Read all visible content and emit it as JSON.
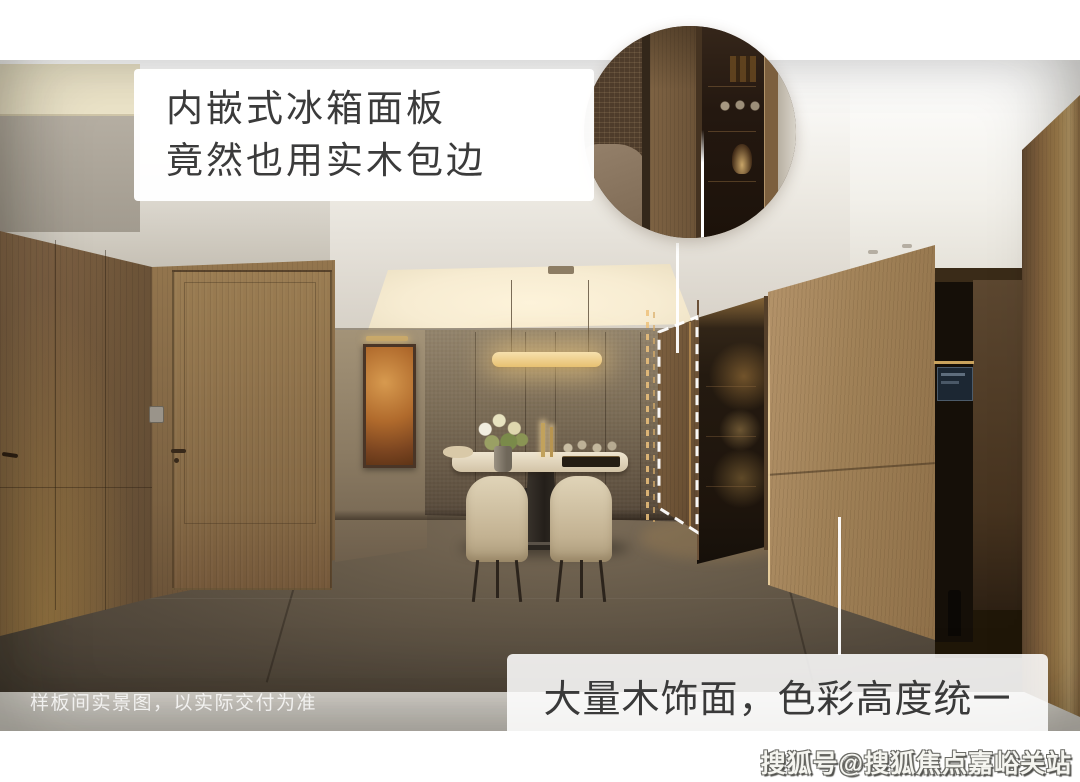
{
  "annotations": {
    "fridge_note_line1": "内嵌式冰箱面板",
    "fridge_note_line2": "竟然也用实木包边",
    "wood_note": "大量木饰面，色彩高度统一",
    "disclaimer": "样板间实景图，以实际交付为准",
    "watermark": "搜狐号@搜狐焦点嘉峪关站"
  },
  "colors": {
    "annotation_text": "#3b3b3b",
    "callout_background": "#ffffff",
    "connector_line": "#ffffff",
    "dashed_outline": "#ffffff",
    "wood_light": "#a5865c",
    "wood_dark": "#5f4a33",
    "bronze_wall": "#6f6150",
    "cove_glow": "#f8edd6",
    "pendant_glow": "#e8c171",
    "floor_gray": "#564c40",
    "carpet_gold": "#b3925e",
    "watermark_white": "#f5f5f0"
  }
}
